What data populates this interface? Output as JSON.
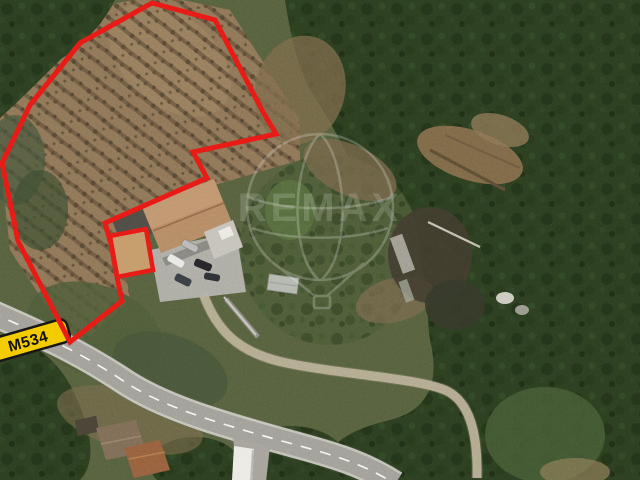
{
  "image": {
    "description": "Aerial satellite photograph of a rural hillside property with terraced olive grove, a house with terracotta roof, parked cars, curving road and dense forest",
    "road_label": "M534",
    "watermark_text": "REMAX",
    "overlay": {
      "boundary_points": "152,3 215,20 263,112 276,134 193,152 207,178 105,223 111,244 118,282 122,301 70,342 18,241 2,163 30,105 80,43",
      "highlight_points": "110,236 146,229 153,270 117,277"
    },
    "colors": {
      "boundary_red": "#e81b17",
      "badge_background": "#f3cc00",
      "badge_border": "#161616",
      "badge_text": "#111111",
      "highlight_fill": "#c79e6e",
      "watermark_white": "#ffffff",
      "forest_green": "#2c3e20",
      "grove_dirt": "#8d7557",
      "road_gray": "#a19f98",
      "roof_terracotta": "#b48a64"
    }
  }
}
